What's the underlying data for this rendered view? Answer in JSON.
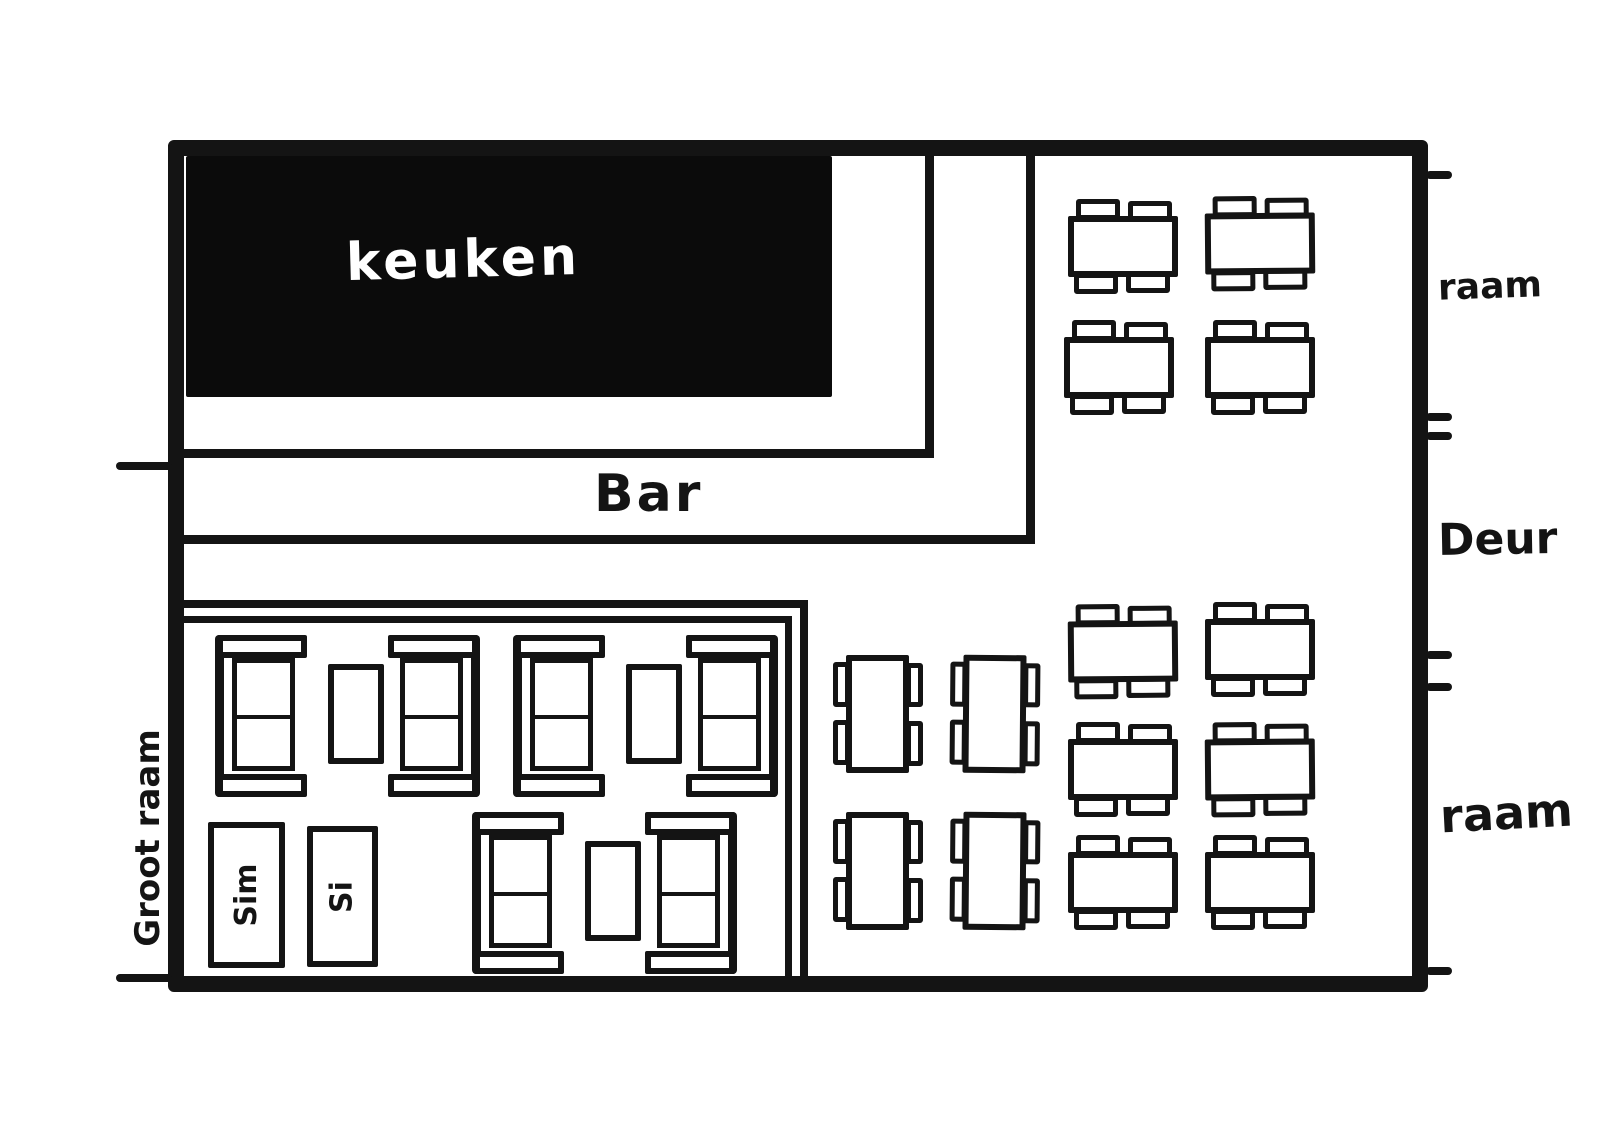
{
  "document": {
    "type": "hand-drawn restaurant floor plan",
    "language": "Dutch"
  },
  "labels": {
    "kitchen": "keuken",
    "bar": "Bar",
    "door": "Deur",
    "window_right_top": "raam",
    "window_right_bottom": "raam",
    "window_left_big": "Groot raam"
  },
  "colors": {
    "ink": "#141414",
    "paper": "#ffffff",
    "kitchen_fill": "#0b0b0b",
    "kitchen_text": "#ffffff"
  },
  "furniture": {
    "tables_4seat_horizontal": [
      {
        "x": 1068,
        "y": 199
      },
      {
        "x": 1205,
        "y": 196
      },
      {
        "x": 1064,
        "y": 320
      },
      {
        "x": 1205,
        "y": 320
      },
      {
        "x": 1068,
        "y": 604
      },
      {
        "x": 1205,
        "y": 602
      },
      {
        "x": 1068,
        "y": 722
      },
      {
        "x": 1205,
        "y": 722
      },
      {
        "x": 1068,
        "y": 835
      },
      {
        "x": 1205,
        "y": 835
      }
    ],
    "tables_4seat_vertical": [
      {
        "x": 833,
        "y": 655
      },
      {
        "x": 950,
        "y": 655
      },
      {
        "x": 833,
        "y": 812
      },
      {
        "x": 950,
        "y": 812
      }
    ],
    "booths_sofa_table_sofa": [
      {
        "x": 215,
        "y": 635
      },
      {
        "x": 513,
        "y": 635
      },
      {
        "x": 472,
        "y": 812
      }
    ],
    "labeled_boxes": [
      {
        "label": "Sim",
        "x": 208,
        "y": 822,
        "w": 77,
        "h": 146
      },
      {
        "label": "Si",
        "x": 307,
        "y": 826,
        "w": 71,
        "h": 141
      }
    ]
  },
  "wall_openings": {
    "right_wall_tick_y": [
      171,
      413,
      432,
      651,
      683,
      967
    ],
    "left_wall_tick_y": [
      462,
      974
    ]
  }
}
